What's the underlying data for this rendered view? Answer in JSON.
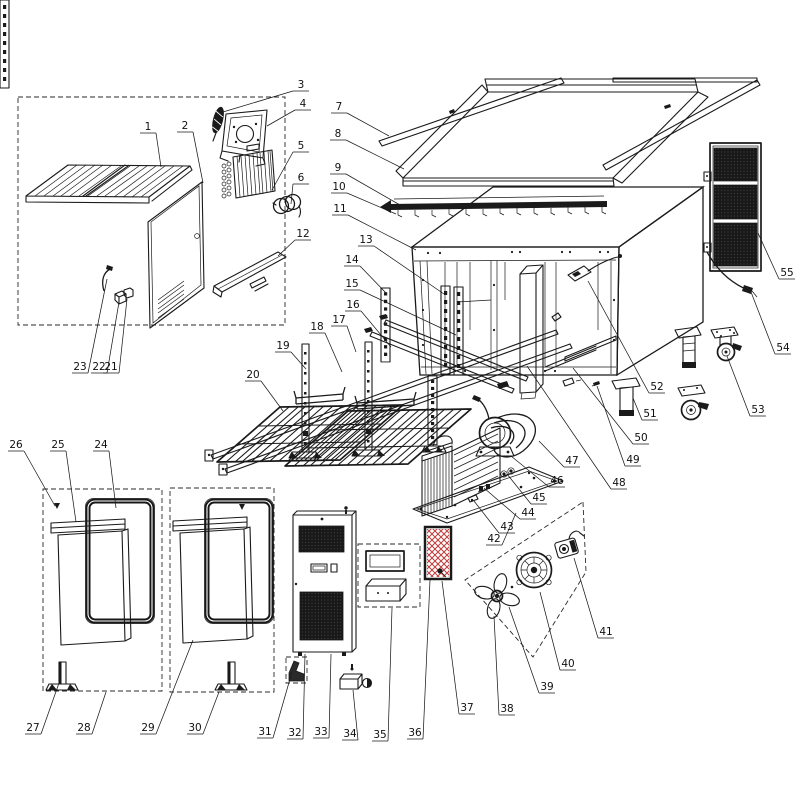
{
  "page": {
    "background": "#ffffff"
  },
  "diagram": {
    "type": "exploded-parts-diagram",
    "subject": "refrigerated-worktable-cabinet",
    "line_color": "#1a1a1a",
    "accent_red": "#bf3b3b",
    "mesh_dark": "#181818",
    "part_count": 55,
    "labels": [
      {
        "n": "1",
        "x": 148,
        "y": 127,
        "tx": 161,
        "ty": 167
      },
      {
        "n": "2",
        "x": 185,
        "y": 126,
        "tx": 203,
        "ty": 183
      },
      {
        "n": "3",
        "x": 301,
        "y": 85,
        "tx": 223,
        "ty": 112
      },
      {
        "n": "4",
        "x": 303,
        "y": 104,
        "tx": 267,
        "ty": 126
      },
      {
        "n": "5",
        "x": 301,
        "y": 146,
        "tx": 272,
        "ty": 190
      },
      {
        "n": "6",
        "x": 301,
        "y": 178,
        "tx": 291,
        "ty": 204
      },
      {
        "n": "7",
        "x": 339,
        "y": 107,
        "tx": 389,
        "ty": 136
      },
      {
        "n": "8",
        "x": 338,
        "y": 134,
        "tx": 404,
        "ty": 169
      },
      {
        "n": "9",
        "x": 338,
        "y": 168,
        "tx": 400,
        "ty": 205
      },
      {
        "n": "10",
        "x": 339,
        "y": 187,
        "tx": 396,
        "ty": 214
      },
      {
        "n": "11",
        "x": 340,
        "y": 209,
        "tx": 416,
        "ty": 250
      },
      {
        "n": "12",
        "x": 303,
        "y": 234,
        "tx": 278,
        "ty": 256
      },
      {
        "n": "13",
        "x": 366,
        "y": 240,
        "tx": 444,
        "ty": 294
      },
      {
        "n": "14",
        "x": 352,
        "y": 260,
        "tx": 386,
        "ty": 293
      },
      {
        "n": "15",
        "x": 352,
        "y": 284,
        "tx": 456,
        "ty": 335
      },
      {
        "n": "16",
        "x": 353,
        "y": 305,
        "tx": 391,
        "ty": 347
      },
      {
        "n": "17",
        "x": 339,
        "y": 320,
        "tx": 356,
        "ty": 352
      },
      {
        "n": "18",
        "x": 317,
        "y": 327,
        "tx": 342,
        "ty": 372
      },
      {
        "n": "19",
        "x": 283,
        "y": 346,
        "tx": 306,
        "ty": 369
      },
      {
        "n": "20",
        "x": 253,
        "y": 375,
        "tx": 283,
        "ty": 411
      },
      {
        "n": "21",
        "x": 111,
        "y": 367,
        "tx": 127,
        "ty": 299
      },
      {
        "n": "22",
        "x": 99,
        "y": 367,
        "tx": 119,
        "ty": 302
      },
      {
        "n": "23",
        "x": 80,
        "y": 367,
        "tx": 107,
        "ty": 279
      },
      {
        "n": "24",
        "x": 101,
        "y": 445,
        "tx": 116,
        "ty": 508
      },
      {
        "n": "25",
        "x": 58,
        "y": 445,
        "tx": 76,
        "ty": 522
      },
      {
        "n": "26",
        "x": 16,
        "y": 445,
        "tx": 55,
        "ty": 506
      },
      {
        "n": "27",
        "x": 33,
        "y": 728,
        "tx": 59,
        "ty": 683
      },
      {
        "n": "28",
        "x": 84,
        "y": 728,
        "tx": 106,
        "ty": 692
      },
      {
        "n": "29",
        "x": 148,
        "y": 728,
        "tx": 193,
        "ty": 640
      },
      {
        "n": "30",
        "x": 195,
        "y": 728,
        "tx": 219,
        "ty": 692
      },
      {
        "n": "31",
        "x": 265,
        "y": 732,
        "tx": 292,
        "ty": 672
      },
      {
        "n": "32",
        "x": 295,
        "y": 733,
        "tx": 305,
        "ty": 654
      },
      {
        "n": "33",
        "x": 321,
        "y": 732,
        "tx": 331,
        "ty": 654
      },
      {
        "n": "34",
        "x": 350,
        "y": 734,
        "tx": 353,
        "ty": 690
      },
      {
        "n": "35",
        "x": 380,
        "y": 735,
        "tx": 392,
        "ty": 608
      },
      {
        "n": "36",
        "x": 415,
        "y": 733,
        "tx": 430,
        "ty": 580
      },
      {
        "n": "37",
        "x": 467,
        "y": 708,
        "tx": 442,
        "ty": 581
      },
      {
        "n": "38",
        "x": 507,
        "y": 709,
        "tx": 494,
        "ty": 616
      },
      {
        "n": "39",
        "x": 547,
        "y": 687,
        "tx": 509,
        "ty": 607
      },
      {
        "n": "40",
        "x": 568,
        "y": 664,
        "tx": 540,
        "ty": 592
      },
      {
        "n": "41",
        "x": 606,
        "y": 632,
        "tx": 574,
        "ty": 558
      },
      {
        "n": "42",
        "x": 494,
        "y": 539,
        "tx": 516,
        "ty": 513
      },
      {
        "n": "43",
        "x": 507,
        "y": 527,
        "tx": 474,
        "ty": 501
      },
      {
        "n": "44",
        "x": 528,
        "y": 513,
        "tx": 484,
        "ty": 488
      },
      {
        "n": "45",
        "x": 539,
        "y": 498,
        "tx": 507,
        "ty": 474
      },
      {
        "n": "46",
        "x": 557,
        "y": 481,
        "tx": 511,
        "ty": 456
      },
      {
        "n": "47",
        "x": 572,
        "y": 461,
        "tx": 539,
        "ty": 441
      },
      {
        "n": "48",
        "x": 619,
        "y": 483,
        "tx": 527,
        "ty": 366
      },
      {
        "n": "49",
        "x": 633,
        "y": 460,
        "tx": 597,
        "ty": 386
      },
      {
        "n": "50",
        "x": 641,
        "y": 438,
        "tx": 573,
        "ty": 368
      },
      {
        "n": "51",
        "x": 650,
        "y": 414,
        "tx": 633,
        "ty": 398
      },
      {
        "n": "52",
        "x": 657,
        "y": 387,
        "tx": 588,
        "ty": 281
      },
      {
        "n": "53",
        "x": 758,
        "y": 410,
        "tx": 727,
        "ty": 356
      },
      {
        "n": "54",
        "x": 783,
        "y": 348,
        "tx": 751,
        "ty": 292
      },
      {
        "n": "55",
        "x": 787,
        "y": 273,
        "tx": 758,
        "ty": 233
      }
    ],
    "arrow_markers": [
      {
        "x": 57,
        "y": 509
      },
      {
        "x": 242,
        "y": 510
      }
    ]
  }
}
